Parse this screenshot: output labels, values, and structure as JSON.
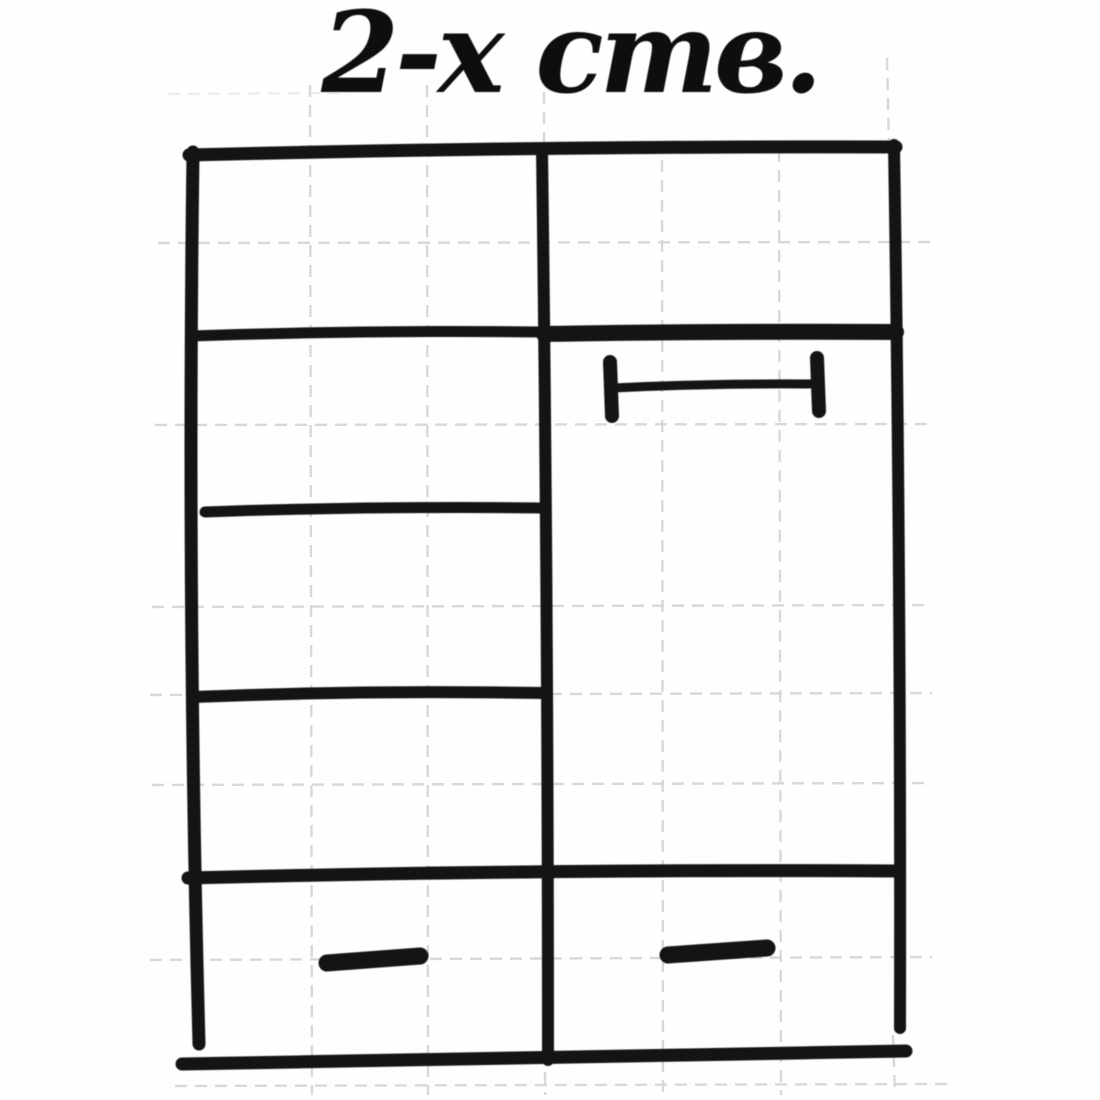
{
  "title": {
    "text": "2-х ств."
  },
  "colors": {
    "ink": "#141414",
    "title_ink": "#0e0e0e",
    "grid": "#bfbfbf",
    "paper": "#fefefe"
  },
  "diagram": {
    "type": "hand-drawn furniture sketch on graph paper",
    "subject": "two-door wardrobe, front elevation",
    "left_section": "shelf compartment with three shelf lines",
    "right_section": "door panel with horizontal handle below bold top rail",
    "bottom_section": "full-width drawer band with two drawers",
    "drawer_handle_count": 2
  }
}
